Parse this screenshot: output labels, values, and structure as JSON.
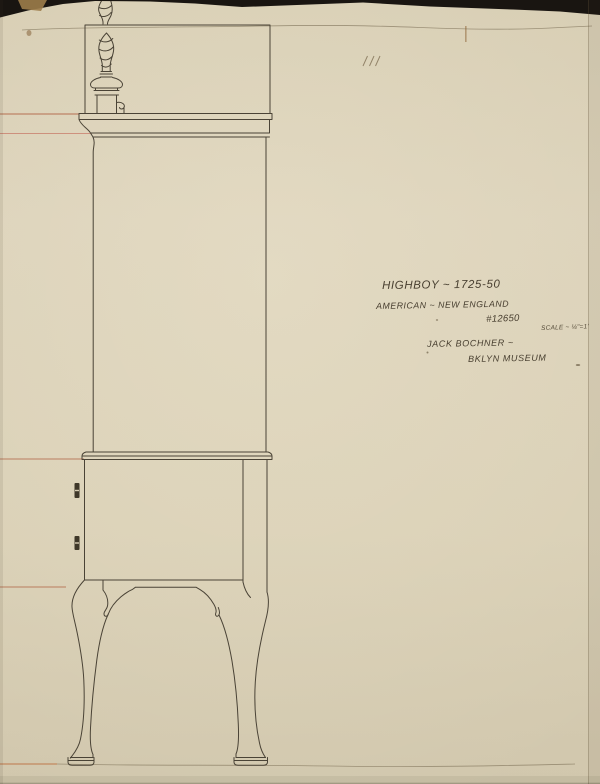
{
  "sheet": {
    "annotations": {
      "title": "HIGHBOY ~ 1725-50",
      "origin": "AMERICAN ~ NEW ENGLAND",
      "object_number": "#12650",
      "scale_note": "SCALE ~ ¼\"=1'",
      "artist_signature": "JACK BOCHNER ~",
      "credit": "BKLYN MUSEUM"
    },
    "drawing_subject": "highboy-side-elevation",
    "colors": {
      "paper": "#d8ceb4",
      "ink": "#4a4336",
      "guide_line_red": "#a84e2e",
      "guide_line_pink": "#c97f6e",
      "pencil": "#877b62",
      "scan_edge": "#191511"
    }
  }
}
